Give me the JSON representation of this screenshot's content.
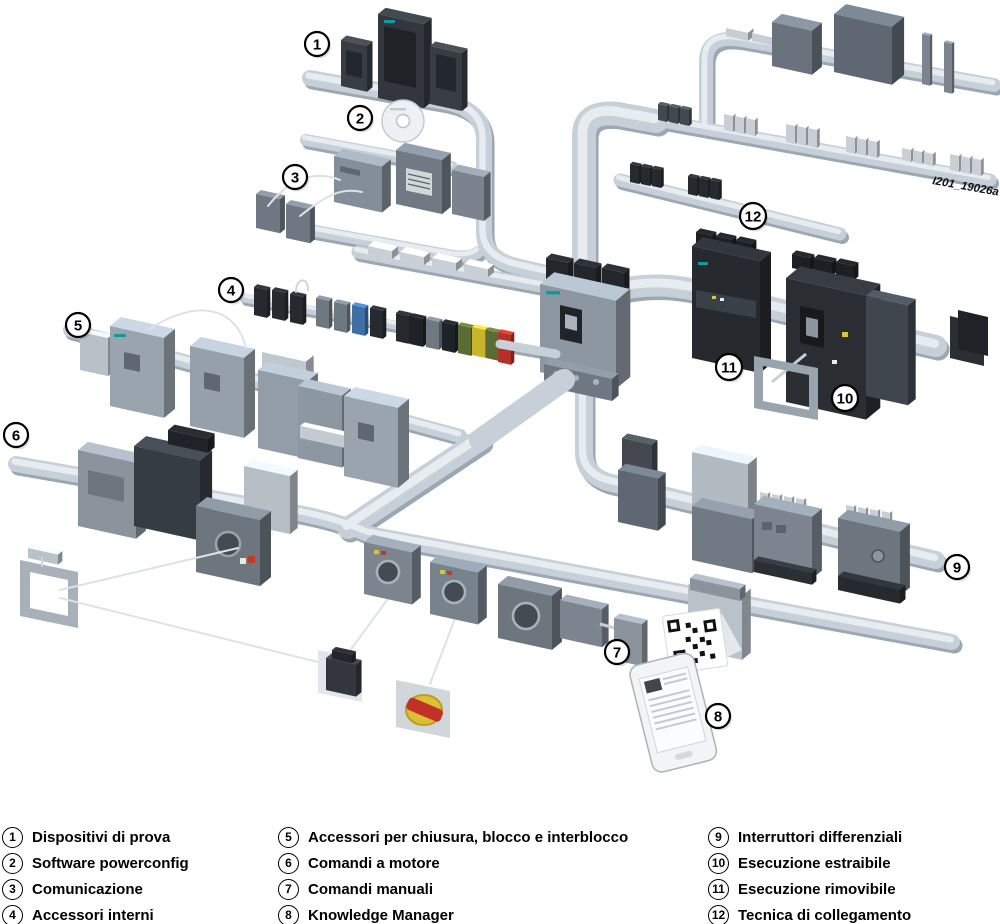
{
  "diagram": {
    "watermark": "I201_19026a",
    "markers": [
      "1",
      "2",
      "3",
      "4",
      "5",
      "6",
      "7",
      "8",
      "9",
      "10",
      "11",
      "12"
    ]
  },
  "legend": {
    "items": [
      {
        "num": "1",
        "label": "Dispositivi di prova"
      },
      {
        "num": "2",
        "label": "Software powerconfig"
      },
      {
        "num": "3",
        "label": "Comunicazione"
      },
      {
        "num": "4",
        "label": "Accessori interni"
      },
      {
        "num": "5",
        "label": "Accessori per chiusura, blocco e interblocco"
      },
      {
        "num": "6",
        "label": "Comandi a motore"
      },
      {
        "num": "7",
        "label": "Comandi manuali"
      },
      {
        "num": "8",
        "label": "Knowledge Manager"
      },
      {
        "num": "9",
        "label": "Interruttori differenziali"
      },
      {
        "num": "10",
        "label": "Esecuzione estraibile"
      },
      {
        "num": "11",
        "label": "Esecuzione rimovibile"
      },
      {
        "num": "12",
        "label": "Tecnica di collegamento"
      }
    ]
  },
  "colors": {
    "background": "#ffffff",
    "rail": "#c7d0d9",
    "rail_shadow": "#9ba7b3",
    "rail_highlight": "#e7ecf0",
    "device_dark": "#26292e",
    "device_gray": "#9aa4ae",
    "device_mid": "#6d767f",
    "accent_teal": "#0f9b9b",
    "accent_red": "#c23127",
    "accent_yellow": "#d9c53b",
    "accent_blue": "#3f6ea5",
    "accent_green": "#5a6b33",
    "callout_bg": "#ffffff",
    "callout_border": "#000000",
    "text": "#000000"
  }
}
